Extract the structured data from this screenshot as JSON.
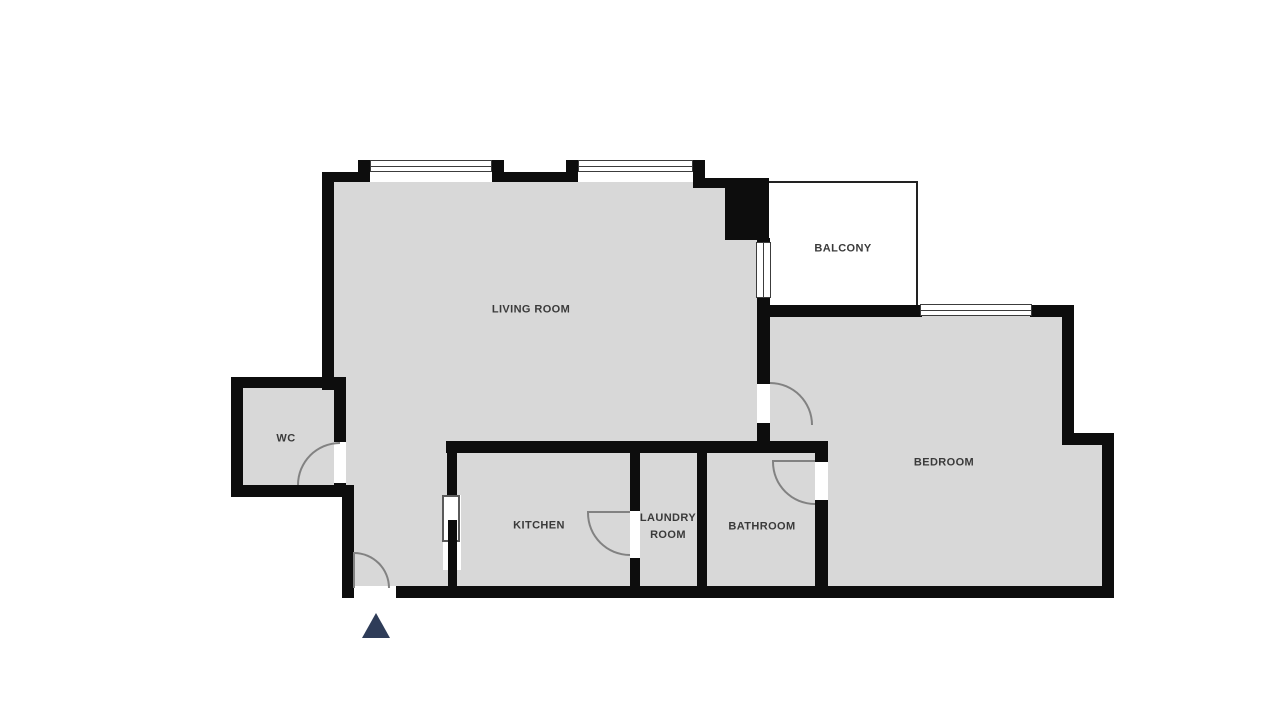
{
  "floorplan": {
    "title": "Apartment floor plan",
    "rooms": [
      {
        "id": "living-room",
        "label": "LIVING ROOM"
      },
      {
        "id": "balcony",
        "label": "BALCONY"
      },
      {
        "id": "bedroom",
        "label": "BEDROOM"
      },
      {
        "id": "wc",
        "label": "WC"
      },
      {
        "id": "kitchen",
        "label": "KITCHEN"
      },
      {
        "id": "laundry-room",
        "label": "LAUNDRY ROOM"
      },
      {
        "id": "bathroom",
        "label": "BATHROOM"
      }
    ],
    "colors": {
      "wall": "#0d0d0d",
      "room_fill": "#d8d8d8",
      "balcony_fill": "#ffffff",
      "door_arc": "#828282",
      "label_text": "#3a3a3a",
      "entrance_marker": "#2e3c58"
    }
  }
}
